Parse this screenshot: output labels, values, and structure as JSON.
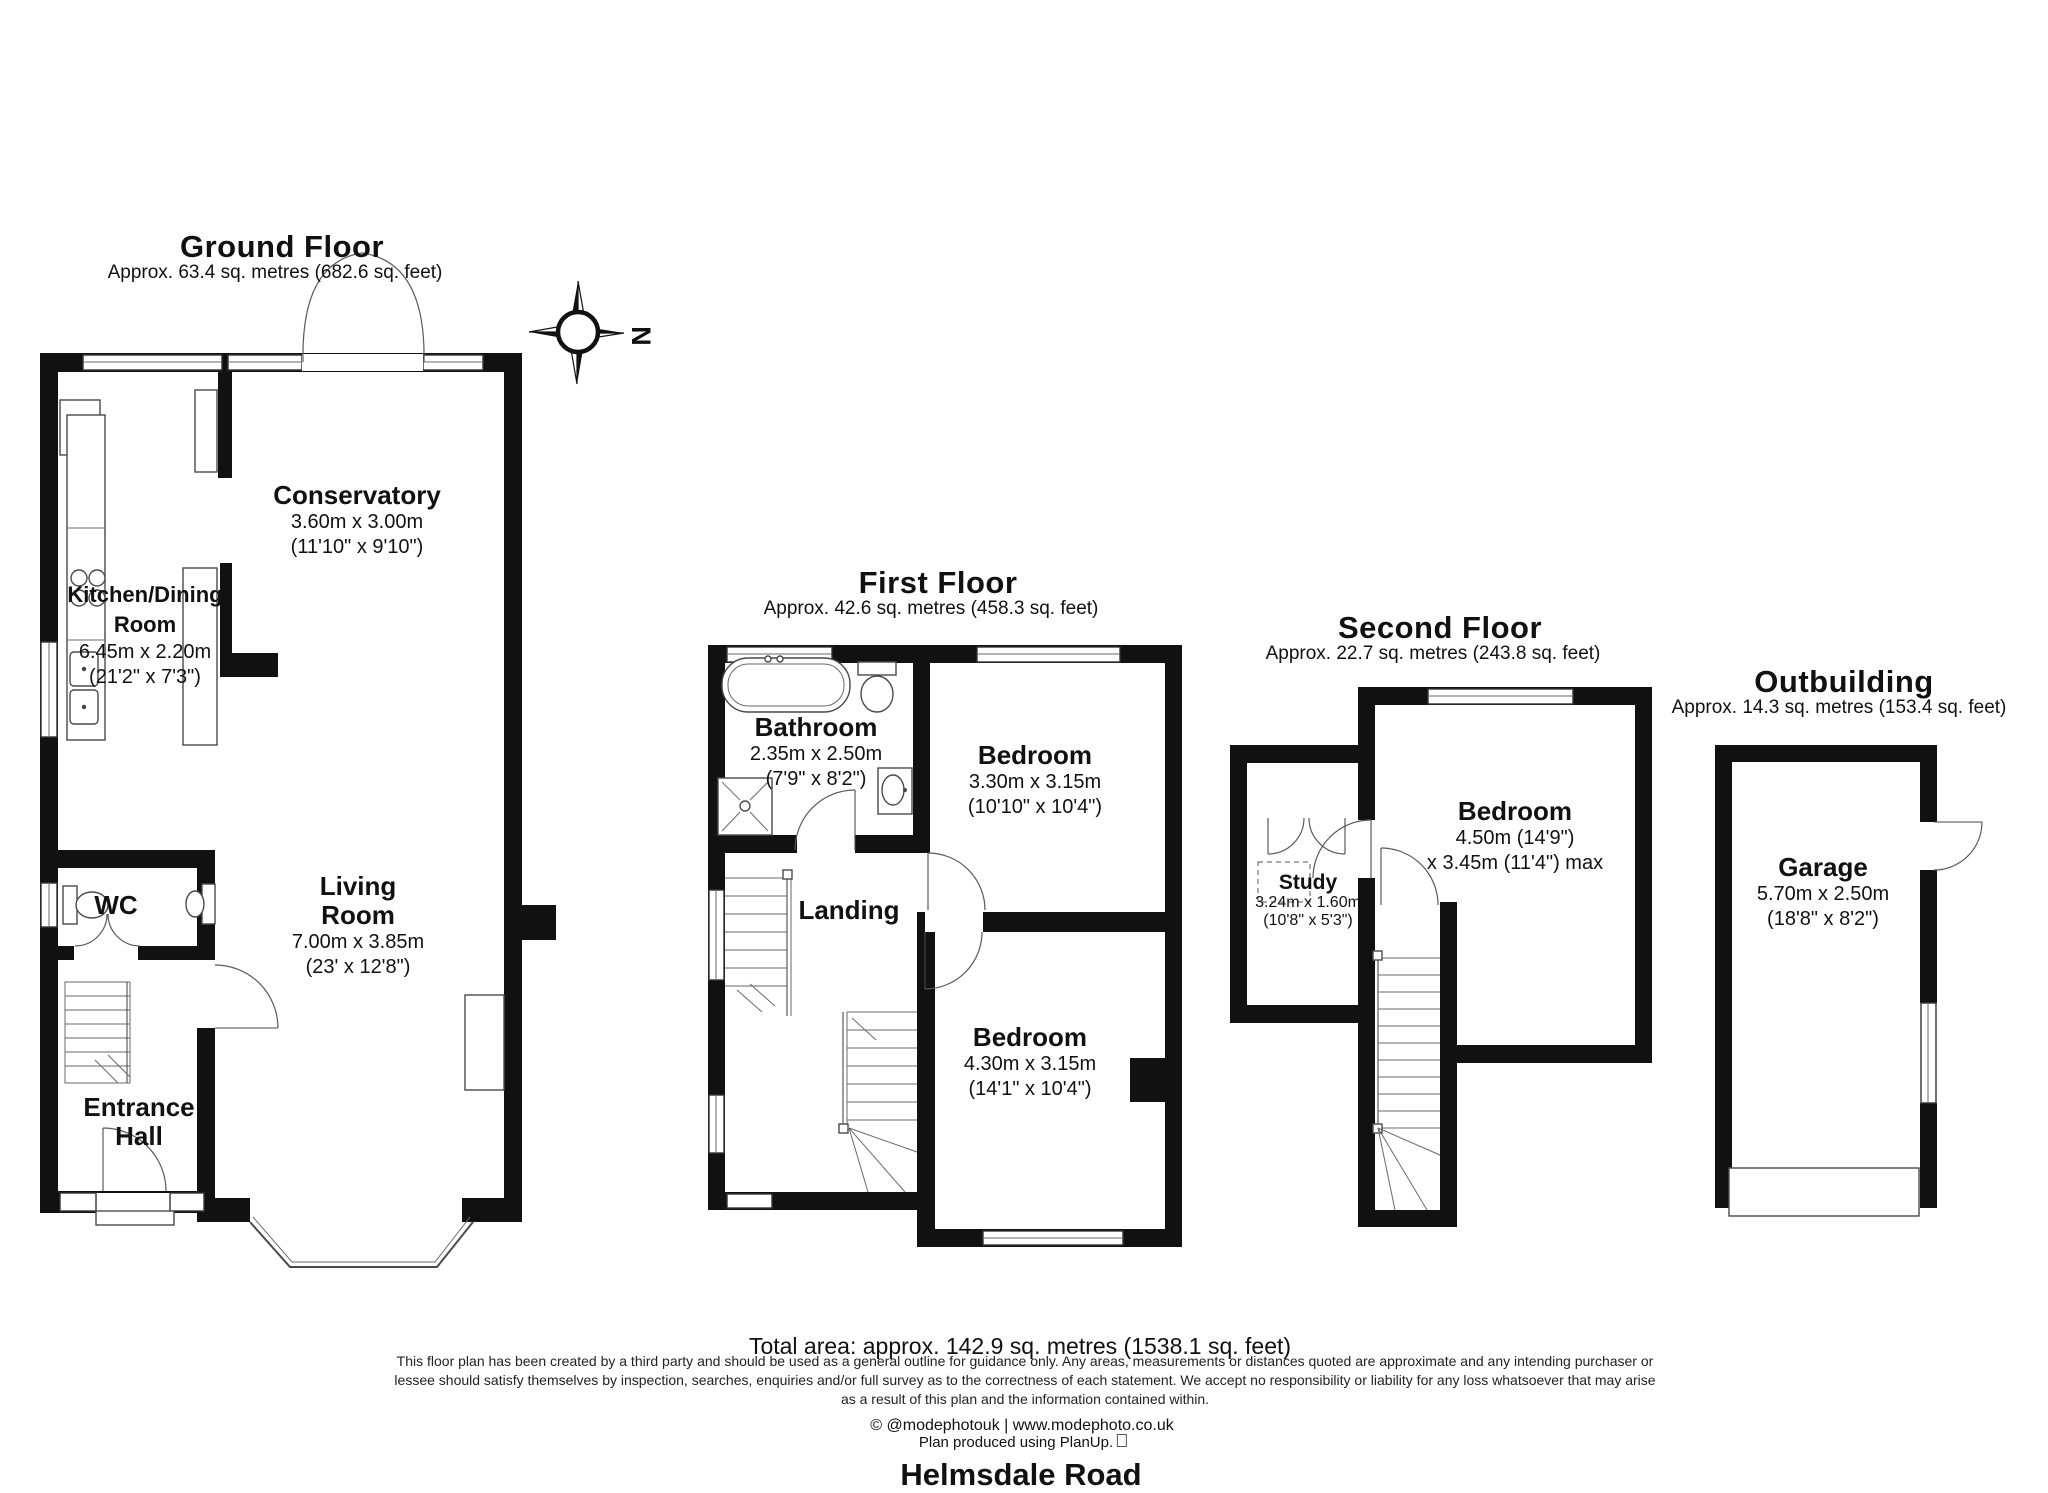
{
  "compass": {
    "north_label": "N"
  },
  "floors": {
    "ground": {
      "title": "Ground Floor",
      "subtitle": "Approx. 63.4 sq. metres (682.6 sq. feet)"
    },
    "first": {
      "title": "First Floor",
      "subtitle": "Approx. 42.6 sq. metres (458.3 sq. feet)"
    },
    "second": {
      "title": "Second Floor",
      "subtitle": "Approx. 22.7 sq. metres (243.8 sq. feet)"
    },
    "outbuilding": {
      "title": "Outbuilding",
      "subtitle": "Approx. 14.3 sq. metres (153.4 sq. feet)"
    }
  },
  "rooms": {
    "conservatory": {
      "name": "Conservatory",
      "metric": "3.60m x 3.00m",
      "imperial": "(11'10\" x 9'10\")"
    },
    "kitchen": {
      "line1": "Kitchen/Dining",
      "line2": "Room",
      "metric": "6.45m x 2.20m",
      "imperial": "(21'2\" x 7'3\")"
    },
    "living": {
      "line1": "Living",
      "line2": "Room",
      "metric": "7.00m x 3.85m",
      "imperial": "(23' x 12'8\")"
    },
    "wc": {
      "name": "WC"
    },
    "entrance_hall": {
      "line1": "Entrance",
      "line2": "Hall"
    },
    "bathroom": {
      "name": "Bathroom",
      "metric": "2.35m x 2.50m",
      "imperial": "(7'9\" x 8'2\")"
    },
    "bedroom_first_front": {
      "name": "Bedroom",
      "metric": "3.30m x 3.15m",
      "imperial": "(10'10\" x 10'4\")"
    },
    "landing": {
      "name": "Landing"
    },
    "bedroom_first_rear": {
      "name": "Bedroom",
      "metric": "4.30m x 3.15m",
      "imperial": "(14'1\" x 10'4\")"
    },
    "bedroom_second": {
      "name": "Bedroom",
      "metric": "4.50m (14'9\")",
      "imperial": "x 3.45m (11'4\") max"
    },
    "study": {
      "name": "Study",
      "metric": "3.24m x 1.60m",
      "imperial": "(10'8\" x 5'3\")"
    },
    "garage": {
      "name": "Garage",
      "metric": "5.70m x 2.50m",
      "imperial": "(18'8\" x 8'2\")"
    }
  },
  "footer": {
    "total_area": "Total area: approx. 142.9 sq. metres (1538.1 sq. feet)",
    "disclaimer_line1": "This floor plan has been created by a third party and should be used as a general outline for guidance only. Any areas, measurements or distances quoted are approximate and any intending purchaser or",
    "disclaimer_line2": "lessee should satisfy themselves by inspection, searches, enquiries and/or full survey as to the correctness of each statement. We accept no responsibility or liability for any loss whatsoever that may arise",
    "disclaimer_line3": "as a result of this plan and the information contained within.",
    "credit": "© @modephotouk | www.modephoto.co.uk",
    "produced": "Plan produced using PlanUp.",
    "address": "Helmsdale Road"
  }
}
